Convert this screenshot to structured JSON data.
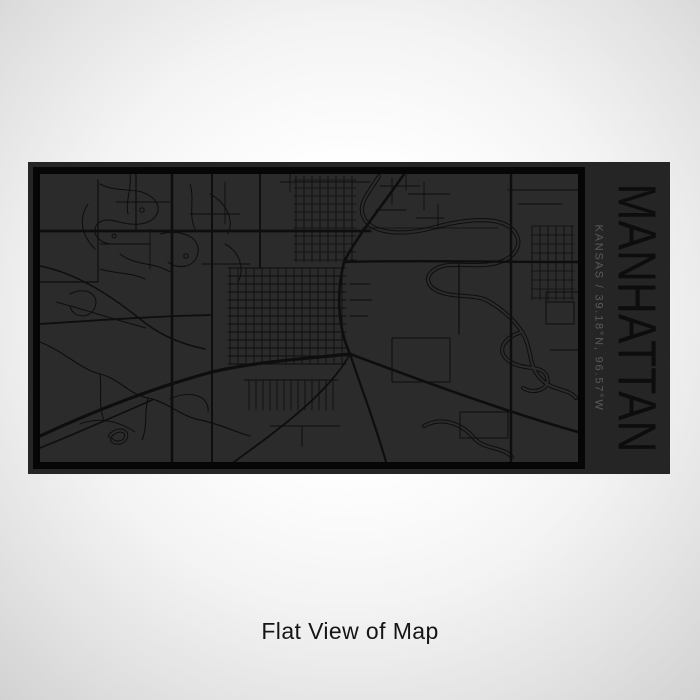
{
  "page": {
    "caption": "Flat View of Map"
  },
  "product": {
    "title": "MANHATTAN",
    "subtitle": "KANSAS / 39.18°N, 96.57°W",
    "location": "Manhattan",
    "state": "KANSAS",
    "latitude": "39.18°N",
    "longitude": "96.57°W"
  },
  "colors": {
    "bg_center": "#ffffff",
    "bg_edge": "#d2d2d2",
    "card_background": "#252525",
    "map_background": "#2b2b2b",
    "roads": "#0e0e0e",
    "frame": "#060606",
    "title_text": "#0d0d0d",
    "subtitle_text": "#5a5a5a",
    "caption_text": "#151515"
  }
}
